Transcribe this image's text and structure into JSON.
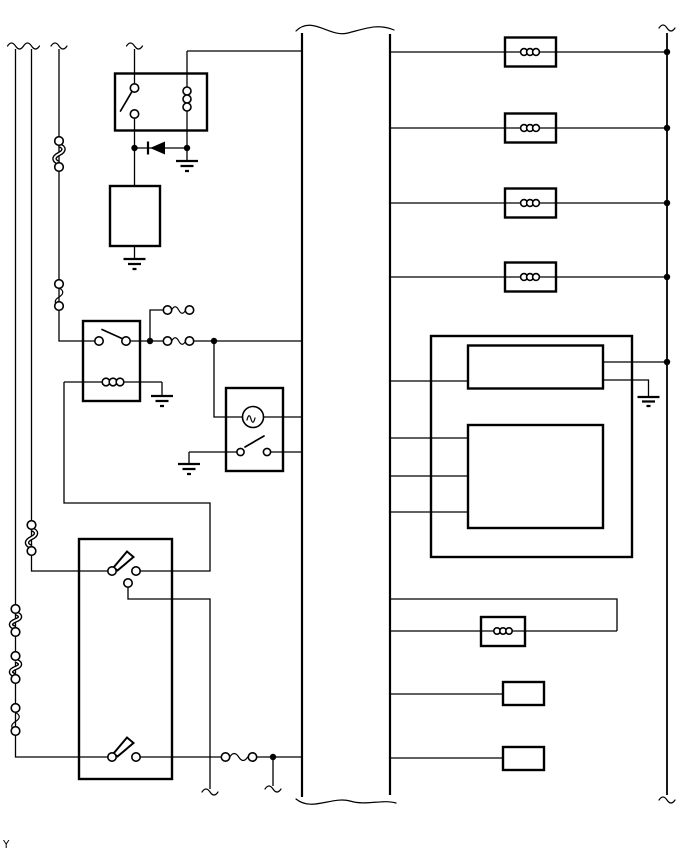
{
  "page": {
    "corner_label": "Y",
    "background_color": "#ffffff",
    "line_color": "#000000"
  },
  "diagram": {
    "type": "automotive-wiring-schematic",
    "text_labels": [
      "Y"
    ],
    "components": {
      "left_side": [
        "supply-wire-1",
        "supply-wire-2",
        "supply-wire-3",
        "fusible-link",
        "fuse",
        "relay-1-with-switch-and-coil",
        "diode",
        "component-box",
        "relay-2-with-switch-and-coil",
        "spare-fuse",
        "lamp-and-switch-unit",
        "two-lever-switch-unit",
        "ground-symbol"
      ],
      "center": [
        "wire-harness-trunk"
      ],
      "right_side": [
        "inductor-box-1",
        "inductor-box-2",
        "inductor-box-3",
        "inductor-box-4",
        "control-unit-outer-box",
        "control-module-upper",
        "control-module-lower",
        "coil-box",
        "connector-box-1",
        "connector-box-2",
        "power-bus"
      ]
    }
  }
}
